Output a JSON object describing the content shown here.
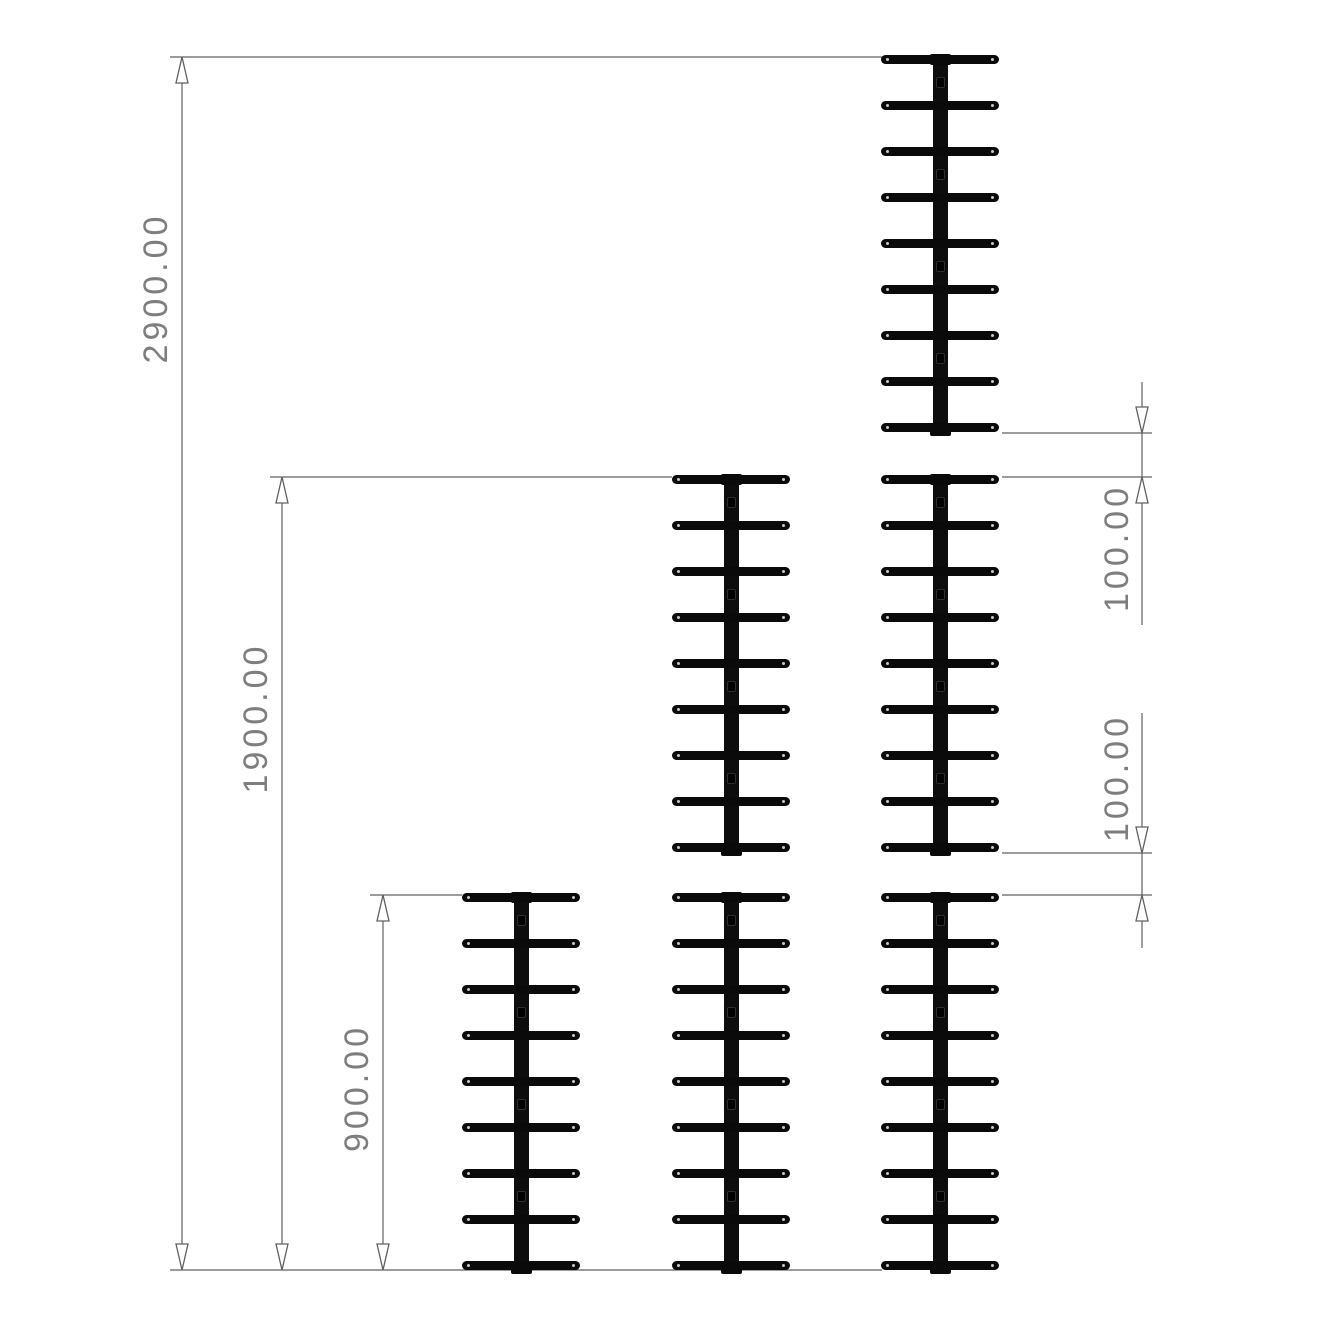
{
  "drawing_title": "tiered-rack-elevation-drawing",
  "colors": {
    "background": "#ffffff",
    "rack": "#0a0a0a",
    "line": "#606060",
    "text": "#7e7e7e"
  },
  "dimensions": [
    {
      "name": "overall-height-three-tier",
      "label": "2900.00",
      "cx": 156,
      "cy": 288
    },
    {
      "name": "overall-height-two-tier",
      "label": "1900.00",
      "cx": 256,
      "cy": 718
    },
    {
      "name": "overall-height-one-tier",
      "label": "900.00",
      "cx": 357,
      "cy": 1088
    },
    {
      "name": "tier-gap-upper",
      "label": "100.00",
      "cx": 1117,
      "cy": 548
    },
    {
      "name": "tier-gap-lower",
      "label": "100.00",
      "cx": 1117,
      "cy": 778
    }
  ],
  "geometry": {
    "dim_lines": [
      {
        "x": 182,
        "y1": 57,
        "y2": 1270,
        "arrows": [
          {
            "y": 57,
            "dir": "up"
          },
          {
            "y": 1270,
            "dir": "down"
          }
        ]
      },
      {
        "x": 282,
        "y1": 477,
        "y2": 1270,
        "arrows": [
          {
            "y": 477,
            "dir": "up"
          },
          {
            "y": 1270,
            "dir": "down"
          }
        ]
      },
      {
        "x": 383,
        "y1": 895,
        "y2": 1270,
        "arrows": [
          {
            "y": 895,
            "dir": "up"
          },
          {
            "y": 1270,
            "dir": "down"
          }
        ]
      },
      {
        "x": 1142,
        "y1": 382,
        "y2": 625,
        "arrows": [
          {
            "y": 433,
            "dir": "down"
          },
          {
            "y": 477,
            "dir": "up"
          }
        ]
      },
      {
        "x": 1142,
        "y1": 713,
        "y2": 948,
        "arrows": [
          {
            "y": 853,
            "dir": "down"
          },
          {
            "y": 895,
            "dir": "up"
          }
        ]
      }
    ],
    "ext_lines": [
      {
        "x1": 170,
        "x2": 884,
        "y": 57
      },
      {
        "x1": 270,
        "x2": 672,
        "y": 477
      },
      {
        "x1": 370,
        "x2": 462,
        "y": 895
      },
      {
        "x1": 170,
        "x2": 882,
        "y": 1270
      },
      {
        "x1": 1002,
        "x2": 1152,
        "y": 433
      },
      {
        "x1": 1002,
        "x2": 1152,
        "y": 477
      },
      {
        "x1": 1002,
        "x2": 1152,
        "y": 853
      },
      {
        "x1": 1002,
        "x2": 1152,
        "y": 895
      }
    ],
    "racks": [
      {
        "cx": 521,
        "top": 892
      },
      {
        "cx": 731,
        "top": 474
      },
      {
        "cx": 731,
        "top": 892
      },
      {
        "cx": 940,
        "top": 54
      },
      {
        "cx": 940,
        "top": 474
      },
      {
        "cx": 940,
        "top": 892
      }
    ],
    "rack_spec": {
      "width": 120,
      "height": 382,
      "bar_w": 15,
      "cap_w": 21,
      "cap_h": 11,
      "prong_count": 9,
      "prong_w": 118,
      "prong_h": 9,
      "first_prong_cy": 5,
      "prong_spacing": 46,
      "bar_hole_cys": [
        28,
        120,
        212,
        304
      ]
    },
    "arrow": {
      "w": 12,
      "h": 26
    }
  }
}
